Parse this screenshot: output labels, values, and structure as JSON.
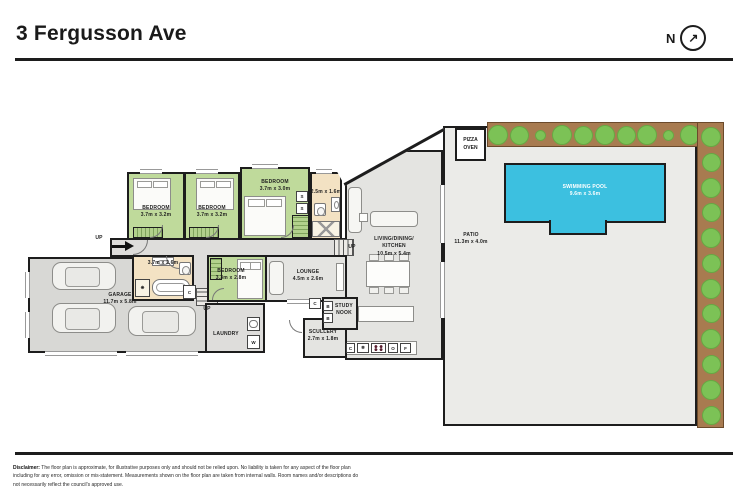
{
  "header": {
    "title": "3 Fergusson Ave",
    "north_label": "N",
    "north_arrow_icon": "↗"
  },
  "plan": {
    "rooms": {
      "bedroom_top_1": {
        "name": "BEDROOM",
        "dims": "3.7m x 3.2m"
      },
      "bedroom_top_2": {
        "name": "BEDROOM",
        "dims": "3.7m x 3.2m"
      },
      "bedroom_top_3": {
        "name": "BEDROOM",
        "dims": "3.7m x 3.0m"
      },
      "ensuite": {
        "dims": "2.5m x 1.6m"
      },
      "living_kitchen": {
        "name_line1": "LIVING/DINING/",
        "name_line2": "KITCHEN",
        "dims": "10.5m x 5.4m"
      },
      "patio": {
        "name": "PATIO",
        "dims": "11.3m x 4.0m"
      },
      "swimming_pool": {
        "name": "SWIMMING POOL",
        "dims": "9.6m x 3.6m"
      },
      "pizza_oven": {
        "name_line1": "PIZZA",
        "name_line2": "OVEN"
      },
      "garage": {
        "name": "GARAGE",
        "dims": "11.7m x 5.8m"
      },
      "bathroom": {
        "dims": "3.7m x 2.6m"
      },
      "bedroom_mid": {
        "name": "BEDROOM",
        "dims": "3.3m x 2.8m"
      },
      "lounge": {
        "name": "LOUNGE",
        "dims": "4.5m x 2.6m"
      },
      "laundry": {
        "name": "LAUNDRY"
      },
      "scullery": {
        "name": "SCULLERY",
        "dims": "2.7m x 1.8m"
      },
      "study_nook": {
        "name_line1": "STUDY",
        "name_line2": "NOOK"
      }
    },
    "markers": {
      "up": "UP",
      "closet": "C",
      "washer": "W",
      "oven": "O",
      "fridge": "F",
      "freezer_icon": "❄",
      "shelf": "S",
      "bookshelf": "B",
      "shower_icon": "❋"
    },
    "garden": {
      "bush_sizes_top": [
        20,
        19,
        11,
        20,
        19,
        20,
        19,
        20,
        11,
        20
      ],
      "bush_sizes_right": [
        20,
        19,
        20,
        19,
        20,
        19,
        20,
        19,
        20,
        19,
        20,
        19
      ]
    }
  },
  "footer": {
    "disclaimer_label": "Disclaimer:",
    "disclaimer_text": "The floor plan is approximate, for illustrative purposes only and should not be relied upon. No liability is taken for any aspect of the floor plan including for any error, omission or mis-statement. Measurements shown on the floor plan are taken from internal walls. Room names and/or descriptions do not necessarily reflect the council's approved use."
  }
}
